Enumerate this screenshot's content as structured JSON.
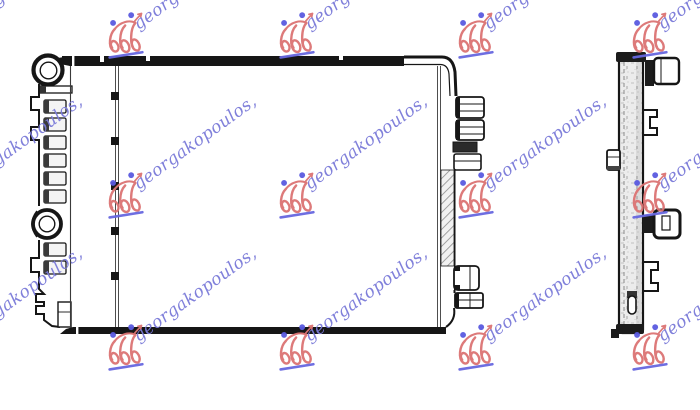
{
  "watermark": {
    "text": "georgakopoulos,",
    "angle_deg": -36,
    "text_color": "#7a7ad9",
    "logo_color": "#dc7373",
    "dot_color": "#5a5ae0",
    "underline_color": "#6767e0",
    "instances": [
      {
        "x": -48,
        "y": 37
      },
      {
        "x": 126,
        "y": 37
      },
      {
        "x": 297,
        "y": 37
      },
      {
        "x": 476,
        "y": 37
      },
      {
        "x": 650,
        "y": 37
      },
      {
        "x": -48,
        "y": 197
      },
      {
        "x": 126,
        "y": 197
      },
      {
        "x": 297,
        "y": 197
      },
      {
        "x": 476,
        "y": 197
      },
      {
        "x": 650,
        "y": 197
      },
      {
        "x": -48,
        "y": 349
      },
      {
        "x": 126,
        "y": 349
      },
      {
        "x": 297,
        "y": 349
      },
      {
        "x": 476,
        "y": 349
      },
      {
        "x": 650,
        "y": 349
      }
    ]
  },
  "figure": {
    "background": "#ffffff",
    "line_color": "#161616",
    "shade_color": "#ececec",
    "hatch_color": "#8a8a8a"
  }
}
